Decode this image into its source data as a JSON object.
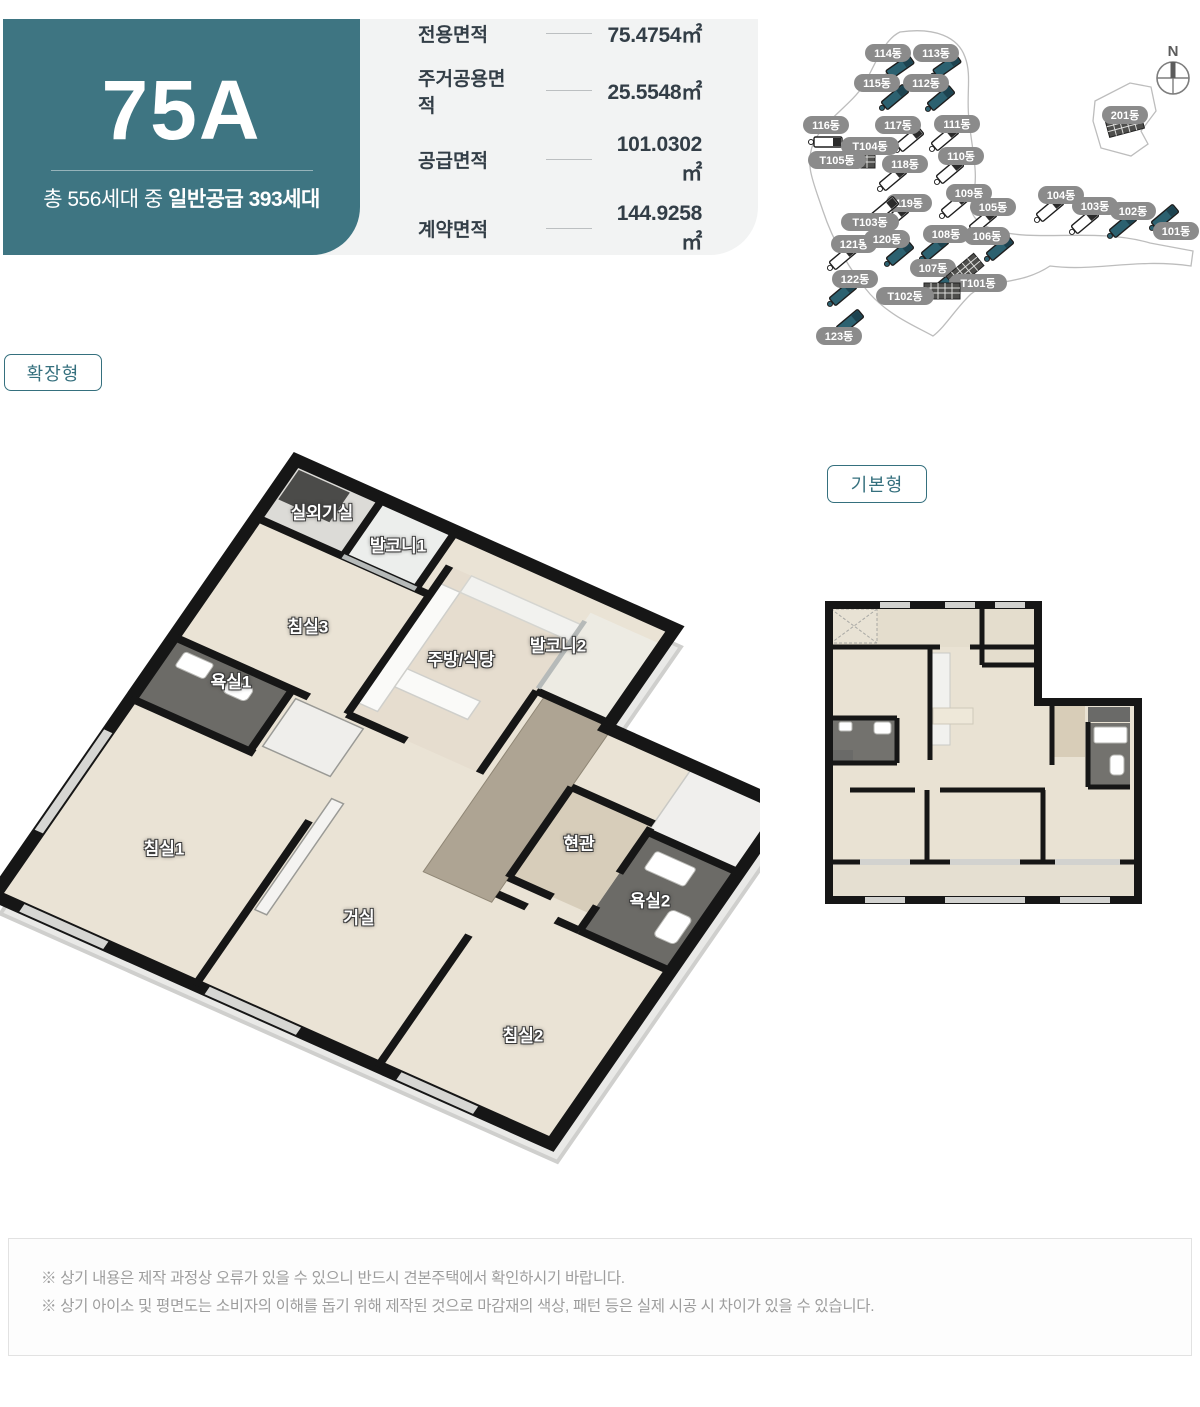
{
  "header": {
    "unit_type": "75A",
    "supply_prefix": "총 556세대 중 ",
    "supply_bold": "일반공급 393세대",
    "teal_color": "#3e7582",
    "specs": [
      {
        "label": "전용면적",
        "value": "75.4754㎡"
      },
      {
        "label": "주거공용면적",
        "value": "25.5548㎡"
      },
      {
        "label": "공급면적",
        "value": "101.0302㎡"
      },
      {
        "label": "계약면적",
        "value": "144.9258㎡"
      }
    ]
  },
  "site_map": {
    "compass_label": "N",
    "pill_color": "#8b8b8b",
    "highlight_color": "#2c6170",
    "buildings": [
      {
        "label": "114동",
        "highlight": true
      },
      {
        "label": "113동",
        "highlight": true
      },
      {
        "label": "115동",
        "highlight": true
      },
      {
        "label": "112동",
        "highlight": true
      },
      {
        "label": "116동",
        "highlight": false
      },
      {
        "label": "117동",
        "highlight": false
      },
      {
        "label": "111동",
        "highlight": false
      },
      {
        "label": "T104동",
        "highlight": false,
        "tower": true
      },
      {
        "label": "T105동",
        "highlight": false,
        "tower": true
      },
      {
        "label": "118동",
        "highlight": false
      },
      {
        "label": "110동",
        "highlight": false
      },
      {
        "label": "201동",
        "highlight": false,
        "tower": true
      },
      {
        "label": "109동",
        "highlight": false
      },
      {
        "label": "119동",
        "highlight": false
      },
      {
        "label": "T103동",
        "highlight": false,
        "tower": true
      },
      {
        "label": "105동",
        "highlight": false
      },
      {
        "label": "104동",
        "highlight": false
      },
      {
        "label": "103동",
        "highlight": false
      },
      {
        "label": "102동",
        "highlight": true
      },
      {
        "label": "101동",
        "highlight": true
      },
      {
        "label": "121동",
        "highlight": false
      },
      {
        "label": "120동",
        "highlight": true
      },
      {
        "label": "108동",
        "highlight": true
      },
      {
        "label": "106동",
        "highlight": true
      },
      {
        "label": "107동",
        "highlight": true
      },
      {
        "label": "T101동",
        "highlight": false,
        "tower": true
      },
      {
        "label": "122동",
        "highlight": true
      },
      {
        "label": "T102동",
        "highlight": false,
        "tower": true
      },
      {
        "label": "123동",
        "highlight": true
      }
    ]
  },
  "plan_extended": {
    "tag": "확장형",
    "rooms": [
      "실외기실",
      "발코니1",
      "침실3",
      "욕실1",
      "주방/식당",
      "발코니2",
      "침실1",
      "거실",
      "현관",
      "욕실2",
      "침실2"
    ]
  },
  "plan_basic": {
    "tag": "기본형"
  },
  "footer": {
    "notes": [
      "※ 상기 내용은 제작 과정상 오류가 있을 수 있으니 반드시 견본주택에서 확인하시기 바랍니다.",
      "※ 상기 아이소 및 평면도는 소비자의 이해를 돕기 위해 제작된 것으로 마감재의 색상, 패턴 등은 실제 시공 시 차이가 있을 수 있습니다."
    ]
  }
}
